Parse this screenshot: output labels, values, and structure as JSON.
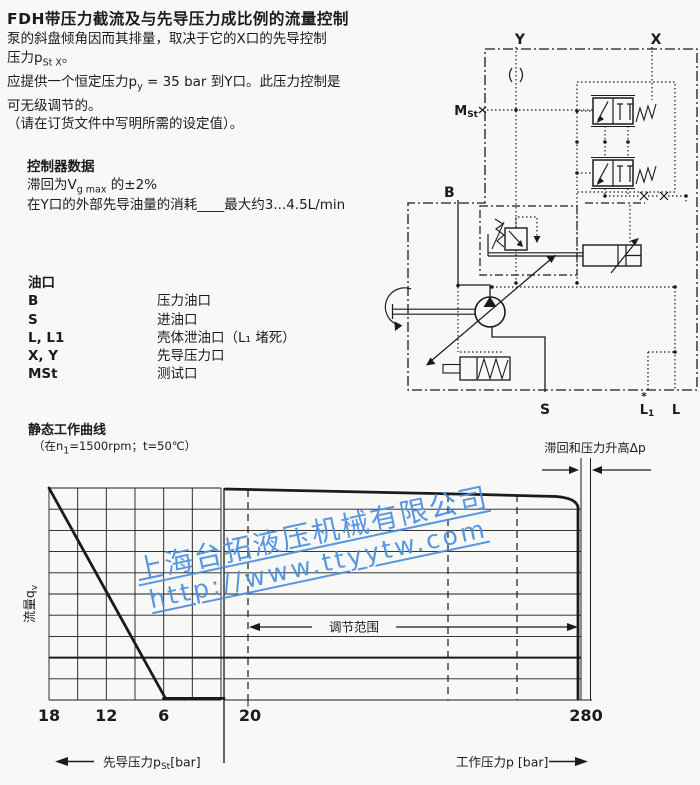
{
  "title": "FDH带压力截流及与先导压力成比例的流量控制",
  "intro": {
    "l1": "泵的斜盘倾角因而其排量，取决于它的X口的先导控制",
    "l2_pre": "压力p",
    "l2_sub": "St X",
    "l2_post": "。",
    "l3_pre": "应提供一个恒定压力p",
    "l3_sub": "y",
    "l3_post": " = 35 bar 到Y口。此压力控制是",
    "l4": "可无级调节的。",
    "l5": "（请在订货文件中写明所需的设定值）。"
  },
  "controller": {
    "heading": "控制器数据",
    "hys_pre": "滞回为V",
    "hys_sub": "g max",
    "hys_post": " 的±2%",
    "consumption": "在Y口的外部先导油量的消耗____最大约3...4.5L/min"
  },
  "ports": {
    "heading": "油口",
    "rows": [
      {
        "code": "B",
        "desc": "压力油口"
      },
      {
        "code": "S",
        "desc": "进油口"
      },
      {
        "code": "L, L1",
        "desc": "壳体泄油口（L₁ 堵死）"
      },
      {
        "code": "X, Y",
        "desc": "先导压力口"
      },
      {
        "code": "MSt",
        "desc": "测试口"
      }
    ]
  },
  "schematic": {
    "labels": {
      "y": "Y",
      "x": "X",
      "mst_m": "M",
      "mst_sub": "St",
      "b": "B",
      "s": "S",
      "l1_main": "L",
      "l1_sub": "1",
      "l1_mark": "*",
      "l": "L"
    }
  },
  "chart": {
    "heading": "静态工作曲线",
    "sub_pre": "（在n",
    "sub_sub": "1",
    "sub_post": "=1500rpm；t=50℃）",
    "hysteresis_label": "滞回和压力升高Δp",
    "range_label": "调节范围",
    "ylabel_pre": "流量q",
    "ylabel_sub": "v",
    "xleft_pre": "先导压力p",
    "xleft_sub": "St",
    "xleft_post": "[bar]",
    "xright": "工作压力p [bar]",
    "ticks": {
      "pilot": [
        "18",
        "12",
        "6"
      ],
      "work": [
        "20",
        "280"
      ]
    }
  },
  "watermark": {
    "line1": "上海台拓液压机械有限公司",
    "line2": "http://www.ttyytw.com",
    "color": "#4a8fe0"
  },
  "chart_data": {
    "type": "line",
    "title": "静态工作曲线",
    "condition": "在n1=1500rpm；t=50℃",
    "ylabel": "流量qv",
    "x_axis_left": {
      "label": "先导压力pSt [bar]",
      "ticks": [
        18,
        12,
        6
      ],
      "note": "values increase toward the left"
    },
    "x_axis_right": {
      "label": "工作压力p [bar]",
      "ticks": [
        20,
        280
      ]
    },
    "series": [
      {
        "name": "流量 vs 先导压力pSt",
        "points_x_bar_y_pct": [
          [
            18,
            100
          ],
          [
            6.5,
            2
          ],
          [
            0,
            2
          ]
        ]
      },
      {
        "name": "流量 vs 工作压力p",
        "points_x_bar_y_pct": [
          [
            2,
            100
          ],
          [
            265,
            96
          ],
          [
            272,
            0
          ]
        ]
      }
    ],
    "annotations": [
      "调节范围 (≈20…280 bar)",
      "滞回和压力升高Δp"
    ],
    "grid": true,
    "legend": false
  }
}
